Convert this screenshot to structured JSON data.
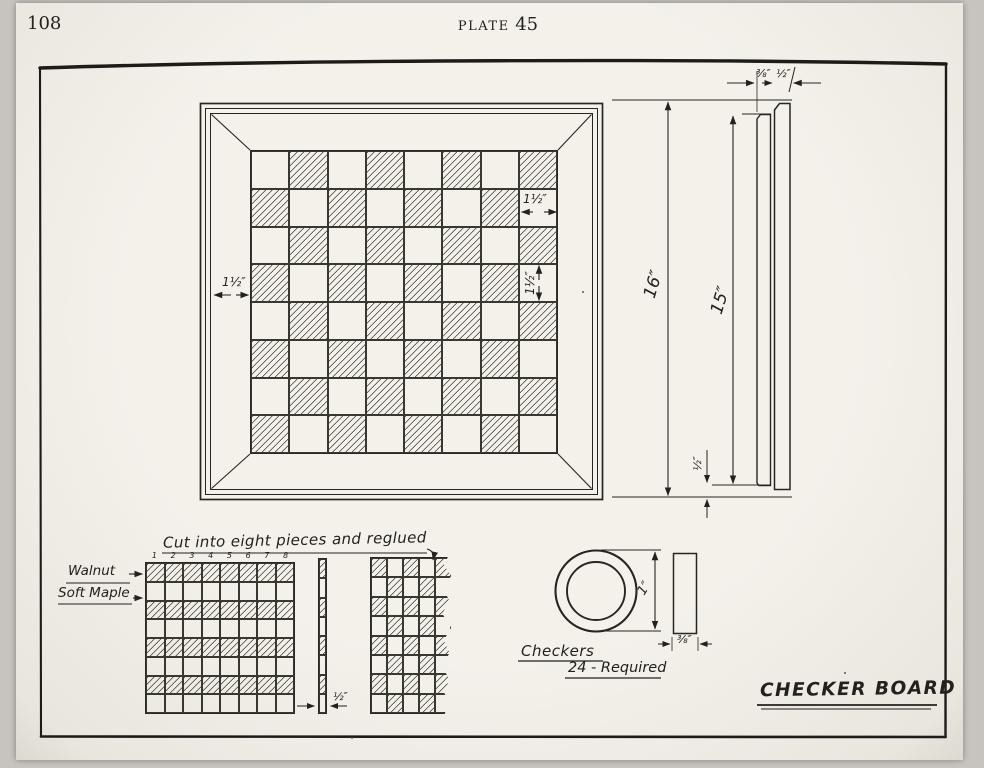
{
  "page": {
    "folio": "108",
    "plate_word": "PLATE",
    "plate_number": "45"
  },
  "drawing_title": "CHECKER BOARD",
  "board_plan": {
    "frame_width_dim": "1½″",
    "square_width_dim": "1½″",
    "square_height_dim": "1½″"
  },
  "side_view": {
    "overall_height": "16″",
    "board_height": "15″",
    "panel_thickness": "⅜″",
    "frame_thickness": "½″",
    "edge_offset": "½″"
  },
  "strip_diagram": {
    "caption": "Cut into eight pieces and reglued",
    "piece_numbers": [
      "1",
      "2",
      "3",
      "4",
      "5",
      "6",
      "7",
      "8"
    ],
    "material_dark": "Walnut",
    "material_light": "Soft Maple",
    "strip_thickness_dim": "½″"
  },
  "checkers_detail": {
    "label": "Checkers",
    "quantity": "24 - Required",
    "diameter_dim": "1″",
    "thickness_dim": "⅜″"
  }
}
